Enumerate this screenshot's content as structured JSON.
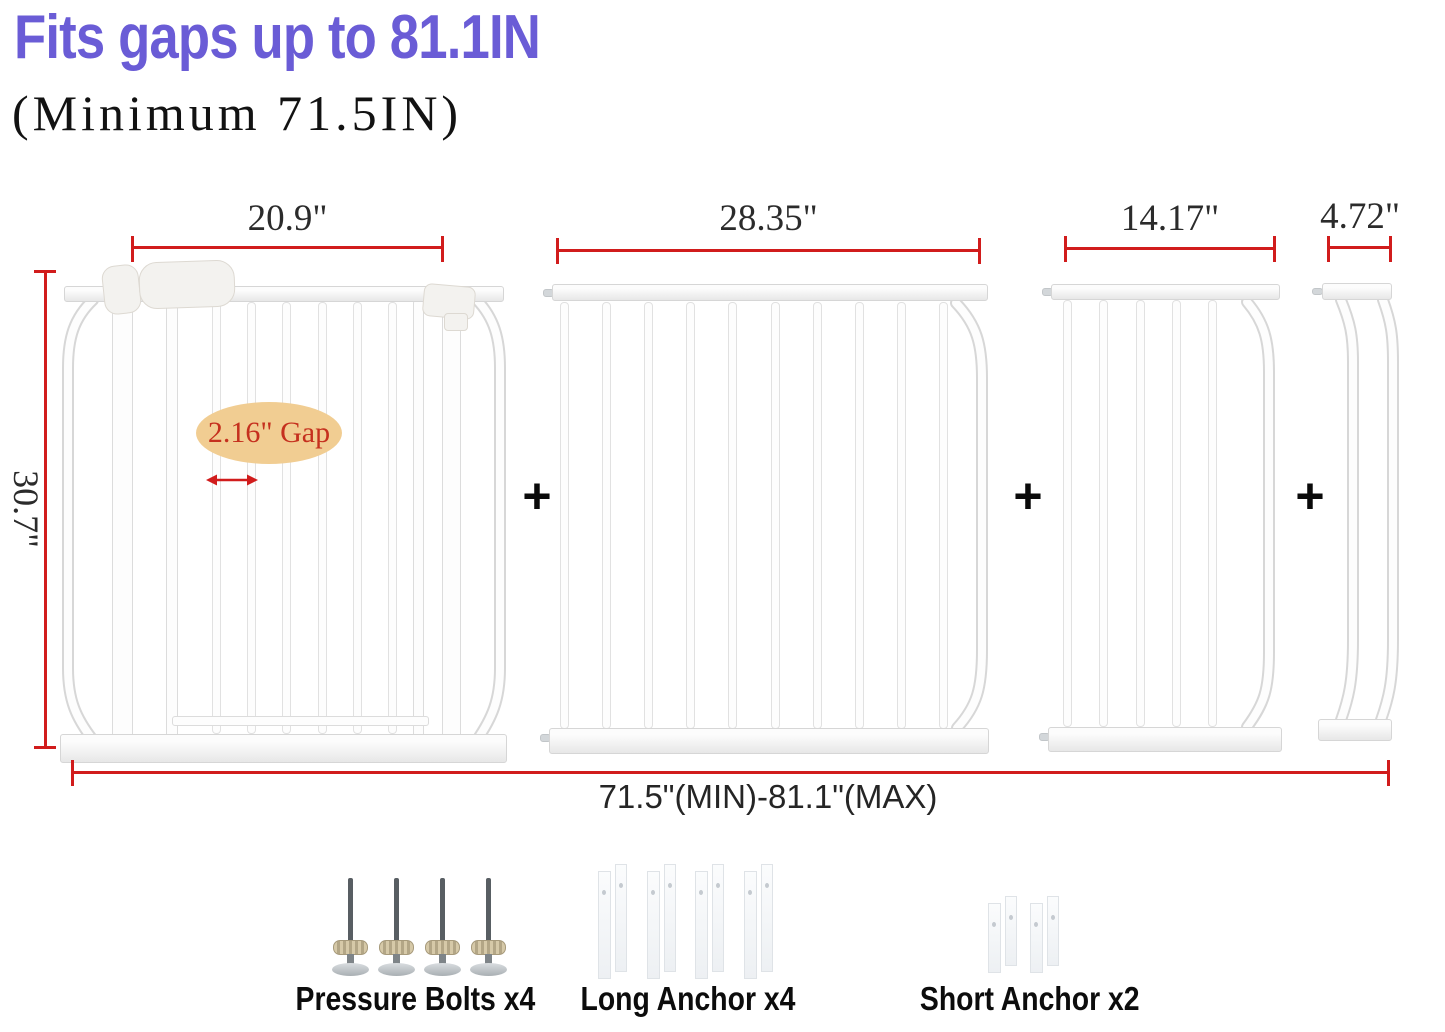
{
  "header": {
    "title": "Fits gaps up to 81.1IN",
    "subtitle": "(Minimum 71.5IN)"
  },
  "dimensions": {
    "panel_widths": [
      "20.9\"",
      "28.35\"",
      "14.17\"",
      "4.72\""
    ],
    "gate_height": "30.7\"",
    "total_range": "71.5\"(MIN)-81.1\"(MAX)",
    "bar_gap": "2.16\" Gap"
  },
  "separators": {
    "plus": "+"
  },
  "panels": [
    {
      "id": "walk-through-gate",
      "width_label": "20.9\"",
      "bars": 6
    },
    {
      "id": "extension-28in",
      "width_label": "28.35\"",
      "bars": 10
    },
    {
      "id": "extension-14in",
      "width_label": "14.17\"",
      "bars": 5
    },
    {
      "id": "extension-4in",
      "width_label": "4.72\"",
      "bars": 0
    }
  ],
  "hardware": [
    {
      "id": "pressure-bolts",
      "label": "Pressure Bolts x4",
      "count": 4
    },
    {
      "id": "long-anchors",
      "label": "Long Anchor x4",
      "count": 4
    },
    {
      "id": "short-anchors",
      "label": "Short Anchor x2",
      "count": 2
    }
  ],
  "colors": {
    "title_purple": "#6A5CD6",
    "dimension_red": "#D11C1C",
    "gap_badge_fill": "#F1CD92",
    "gap_badge_text": "#C5301E"
  }
}
